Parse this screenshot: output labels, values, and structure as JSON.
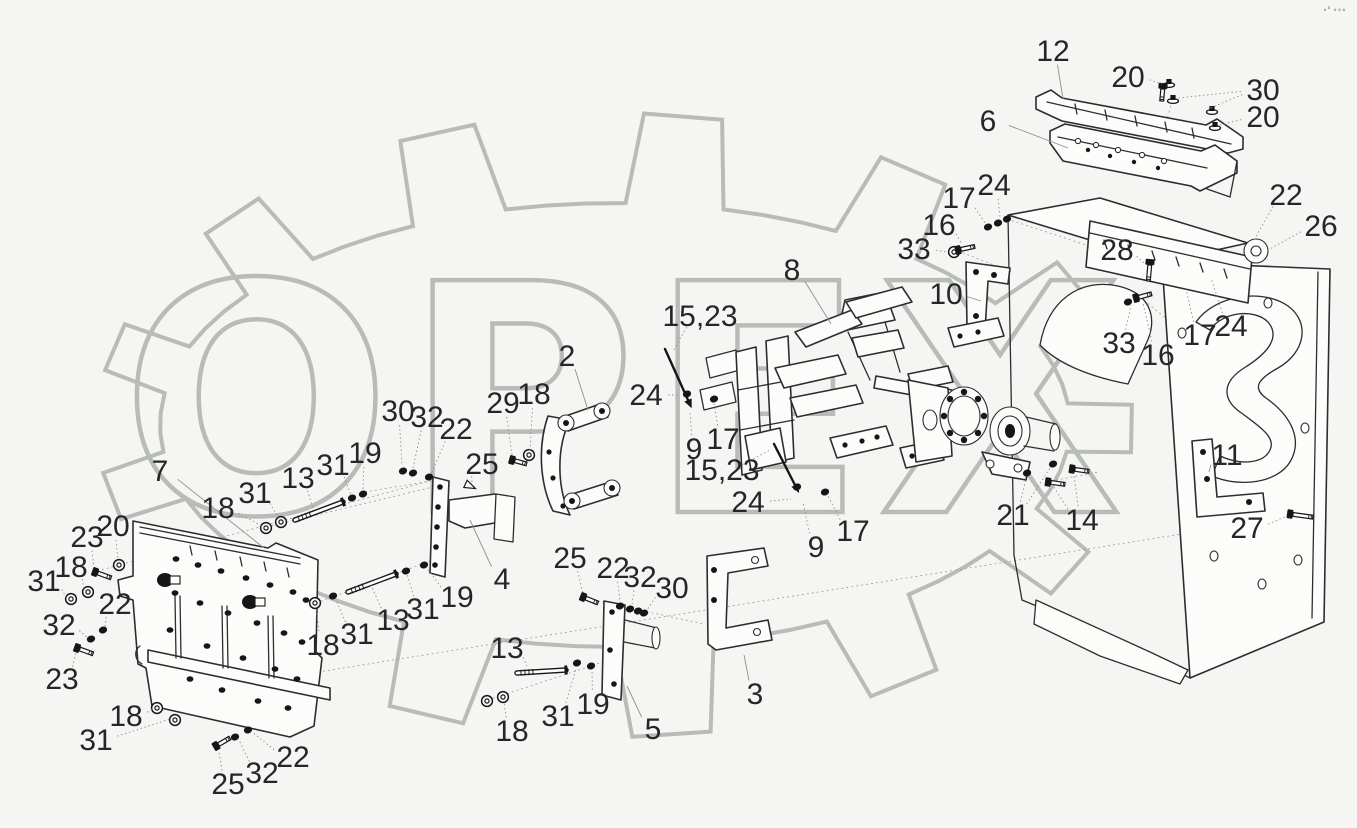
{
  "watermark": {
    "text": "ОРЕХ",
    "color": "#b8bcb8",
    "corner_mark": "∘° ∘∘∘"
  },
  "colors": {
    "background": "#f5f6f3",
    "line": "#2d2d2d",
    "label": "#262626",
    "leader": "#8f8f8f"
  },
  "labels": [
    {
      "t": "12",
      "x": 1053,
      "y": 51,
      "tx": 1063,
      "ty": 99,
      "solid": true
    },
    {
      "t": "20",
      "x": 1128,
      "y": 77,
      "tx": 1162,
      "ty": 84
    },
    {
      "t": "30",
      "x": 1263,
      "y": 90,
      "tx": 1208,
      "ty": 109,
      "tx2": 1178,
      "ty2": 98
    },
    {
      "t": "20",
      "x": 1263,
      "y": 117,
      "tx": 1220,
      "ty": 125
    },
    {
      "t": "6",
      "x": 988,
      "y": 121,
      "tx": 1068,
      "ty": 148,
      "solid": true
    },
    {
      "t": "24",
      "x": 994,
      "y": 185,
      "tx": 1000,
      "ty": 217
    },
    {
      "t": "17",
      "x": 959,
      "y": 198,
      "tx": 986,
      "ty": 224
    },
    {
      "t": "16",
      "x": 939,
      "y": 225,
      "tx": 961,
      "ty": 243
    },
    {
      "t": "33",
      "x": 914,
      "y": 249,
      "tx": 947,
      "ty": 252
    },
    {
      "t": "22",
      "x": 1286,
      "y": 195,
      "tx": 1254,
      "ty": 240
    },
    {
      "t": "26",
      "x": 1321,
      "y": 226,
      "tx": 1268,
      "ty": 250
    },
    {
      "t": "28",
      "x": 1117,
      "y": 250,
      "tx": 1145,
      "ty": 264
    },
    {
      "t": "8",
      "x": 792,
      "y": 270,
      "tx": 831,
      "ty": 324,
      "solid": true
    },
    {
      "t": "10",
      "x": 946,
      "y": 294,
      "tx": 981,
      "ty": 301,
      "solid": true
    },
    {
      "t": "33",
      "x": 1119,
      "y": 343,
      "tx": 1131,
      "ty": 305
    },
    {
      "t": "16",
      "x": 1158,
      "y": 355,
      "tx": 1143,
      "ty": 303
    },
    {
      "t": "17",
      "x": 1200,
      "y": 335,
      "tx": 1186,
      "ty": 289
    },
    {
      "t": "24",
      "x": 1231,
      "y": 326,
      "tx": 1211,
      "ty": 278
    },
    {
      "t": "15,23",
      "x": 700,
      "y": 316,
      "tx": 673,
      "ty": 351
    },
    {
      "t": "2",
      "x": 567,
      "y": 356,
      "tx": 588,
      "ty": 410,
      "solid": true
    },
    {
      "t": "24",
      "x": 646,
      "y": 395,
      "tx": 680,
      "ty": 395
    },
    {
      "t": "9",
      "x": 694,
      "y": 449,
      "tx": 690,
      "ty": 412
    },
    {
      "t": "17",
      "x": 723,
      "y": 439,
      "tx": 714,
      "ty": 403
    },
    {
      "t": "15,23",
      "x": 722,
      "y": 470,
      "tx": 770,
      "ty": 450
    },
    {
      "t": "24",
      "x": 748,
      "y": 502,
      "tx": 791,
      "ty": 499
    },
    {
      "t": "9",
      "x": 816,
      "y": 547,
      "tx": 803,
      "ty": 503
    },
    {
      "t": "17",
      "x": 853,
      "y": 531,
      "tx": 828,
      "ty": 496
    },
    {
      "t": "30",
      "x": 398,
      "y": 411,
      "tx": 402,
      "ty": 466
    },
    {
      "t": "32",
      "x": 427,
      "y": 417,
      "tx": 413,
      "ty": 468
    },
    {
      "t": "22",
      "x": 456,
      "y": 429,
      "tx": 431,
      "ty": 474
    },
    {
      "t": "29",
      "x": 503,
      "y": 403,
      "tx": 512,
      "ty": 455
    },
    {
      "t": "18",
      "x": 534,
      "y": 394,
      "tx": 530,
      "ty": 450
    },
    {
      "t": "25",
      "x": 482,
      "y": 464,
      "tx": 472,
      "ty": 483
    },
    {
      "t": "19",
      "x": 365,
      "y": 453,
      "tx": 363,
      "ty": 490
    },
    {
      "t": "31",
      "x": 333,
      "y": 465,
      "tx": 351,
      "ty": 495
    },
    {
      "t": "13",
      "x": 298,
      "y": 478,
      "tx": 313,
      "ty": 509
    },
    {
      "t": "31",
      "x": 255,
      "y": 493,
      "tx": 279,
      "ty": 519
    },
    {
      "t": "18",
      "x": 218,
      "y": 508,
      "tx": 262,
      "ty": 526
    },
    {
      "t": "7",
      "x": 160,
      "y": 471,
      "tx": 264,
      "ty": 548,
      "solid": true
    },
    {
      "t": "20",
      "x": 113,
      "y": 526,
      "tx": 118,
      "ty": 561
    },
    {
      "t": "23",
      "x": 87,
      "y": 537,
      "tx": 94,
      "ty": 567
    },
    {
      "t": "18",
      "x": 71,
      "y": 567,
      "tx": 84,
      "ty": 589
    },
    {
      "t": "31",
      "x": 44,
      "y": 581,
      "tx": 66,
      "ty": 597
    },
    {
      "t": "22",
      "x": 115,
      "y": 604,
      "tx": 105,
      "ty": 627
    },
    {
      "t": "32",
      "x": 59,
      "y": 625,
      "tx": 87,
      "ty": 637
    },
    {
      "t": "23",
      "x": 62,
      "y": 679,
      "tx": 76,
      "ty": 653
    },
    {
      "t": "18",
      "x": 126,
      "y": 716,
      "tx": 152,
      "ty": 709
    },
    {
      "t": "31",
      "x": 96,
      "y": 740,
      "tx": 170,
      "ty": 719
    },
    {
      "t": "25",
      "x": 228,
      "y": 784,
      "tx": 219,
      "ty": 752
    },
    {
      "t": "32",
      "x": 262,
      "y": 773,
      "tx": 239,
      "ty": 740
    },
    {
      "t": "22",
      "x": 293,
      "y": 757,
      "tx": 252,
      "ty": 732
    },
    {
      "t": "18",
      "x": 323,
      "y": 645,
      "tx": 316,
      "ty": 607
    },
    {
      "t": "31",
      "x": 357,
      "y": 634,
      "tx": 336,
      "ty": 600
    },
    {
      "t": "13",
      "x": 393,
      "y": 620,
      "tx": 371,
      "ty": 585
    },
    {
      "t": "31",
      "x": 423,
      "y": 609,
      "tx": 407,
      "ty": 574
    },
    {
      "t": "19",
      "x": 457,
      "y": 597,
      "tx": 427,
      "ty": 568
    },
    {
      "t": "4",
      "x": 502,
      "y": 579,
      "tx": 470,
      "ty": 520,
      "solid": true
    },
    {
      "t": "25",
      "x": 570,
      "y": 558,
      "tx": 583,
      "ty": 593
    },
    {
      "t": "22",
      "x": 613,
      "y": 568,
      "tx": 620,
      "ty": 601
    },
    {
      "t": "32",
      "x": 640,
      "y": 577,
      "tx": 632,
      "ty": 605
    },
    {
      "t": "30",
      "x": 672,
      "y": 588,
      "tx": 647,
      "ty": 610
    },
    {
      "t": "13",
      "x": 507,
      "y": 648,
      "tx": 527,
      "ty": 666
    },
    {
      "t": "31",
      "x": 558,
      "y": 716,
      "tx": 576,
      "ty": 669
    },
    {
      "t": "19",
      "x": 593,
      "y": 704,
      "tx": 592,
      "ty": 670
    },
    {
      "t": "18",
      "x": 512,
      "y": 731,
      "tx": 504,
      "ty": 702
    },
    {
      "t": "5",
      "x": 653,
      "y": 729,
      "tx": 627,
      "ty": 686,
      "solid": true
    },
    {
      "t": "3",
      "x": 755,
      "y": 694,
      "tx": 744,
      "ty": 655,
      "solid": true
    },
    {
      "t": "21",
      "x": 1013,
      "y": 515,
      "tx": 1026,
      "ty": 479,
      "tx2": 1050,
      "ty2": 468
    },
    {
      "t": "14",
      "x": 1082,
      "y": 520,
      "tx": 1074,
      "ty": 475,
      "tx2": 1052,
      "ty2": 484
    },
    {
      "t": "11",
      "x": 1227,
      "y": 455,
      "tx": 1209,
      "ty": 472,
      "solid": true
    },
    {
      "t": "27",
      "x": 1247,
      "y": 528,
      "tx": 1285,
      "ty": 517
    }
  ],
  "hardware": {
    "dots": [
      [
        403,
        471
      ],
      [
        413,
        473
      ],
      [
        429,
        477
      ],
      [
        988,
        227
      ],
      [
        998,
        223
      ],
      [
        1007,
        219
      ],
      [
        1128,
        302
      ],
      [
        687,
        394
      ],
      [
        714,
        399
      ],
      [
        797,
        487
      ],
      [
        825,
        492
      ],
      [
        620,
        606
      ],
      [
        630,
        609
      ],
      [
        638,
        611
      ],
      [
        644,
        613
      ],
      [
        103,
        630
      ],
      [
        91,
        639
      ],
      [
        235,
        737
      ],
      [
        248,
        730
      ],
      [
        333,
        596
      ],
      [
        406,
        571
      ],
      [
        424,
        565
      ],
      [
        577,
        663
      ],
      [
        591,
        666
      ],
      [
        352,
        498
      ],
      [
        363,
        494
      ],
      [
        1027,
        473
      ],
      [
        1053,
        464
      ]
    ],
    "rings": [
      [
        266,
        528
      ],
      [
        281,
        522
      ],
      [
        315,
        603
      ],
      [
        487,
        701
      ],
      [
        503,
        697
      ],
      [
        88,
        592
      ],
      [
        71,
        599
      ],
      [
        157,
        708
      ],
      [
        175,
        720
      ],
      [
        119,
        565
      ],
      [
        954,
        252
      ],
      [
        529,
        455
      ]
    ],
    "nuts": [
      [
        1169,
        83
      ],
      [
        1173,
        99
      ],
      [
        1212,
        110
      ],
      [
        1215,
        126
      ]
    ],
    "bolts": [
      [
        95,
        572,
        20,
        14
      ],
      [
        77,
        648,
        20,
        14
      ],
      [
        216,
        746,
        -30,
        13
      ],
      [
        583,
        597,
        22,
        13
      ],
      [
        512,
        460,
        15,
        12
      ],
      [
        958,
        250,
        -12,
        14
      ],
      [
        1136,
        298,
        -15,
        13
      ],
      [
        1163,
        86,
        95,
        12
      ],
      [
        1150,
        262,
        95,
        16
      ],
      [
        1048,
        482,
        8,
        14
      ],
      [
        1072,
        469,
        8,
        14
      ],
      [
        1290,
        514,
        8,
        20
      ]
    ],
    "studs": [
      [
        295,
        520,
        343,
        502
      ],
      [
        348,
        592,
        396,
        574
      ],
      [
        517,
        673,
        566,
        670
      ]
    ],
    "rods": [
      [
        665,
        349,
        688,
        400
      ],
      [
        774,
        444,
        795,
        485
      ]
    ],
    "cones": [
      [
        470,
        486,
        25
      ]
    ],
    "panel_dots": [
      [
        176,
        559
      ],
      [
        198,
        565
      ],
      [
        221,
        571
      ],
      [
        246,
        578
      ],
      [
        270,
        585
      ],
      [
        293,
        592
      ],
      [
        306,
        600
      ],
      [
        175,
        593
      ],
      [
        200,
        603
      ],
      [
        228,
        613
      ],
      [
        257,
        623
      ],
      [
        284,
        633
      ],
      [
        302,
        642
      ],
      [
        170,
        630
      ],
      [
        207,
        646
      ],
      [
        243,
        658
      ],
      [
        275,
        669
      ],
      [
        297,
        679
      ],
      [
        190,
        679
      ],
      [
        222,
        690
      ],
      [
        258,
        701
      ],
      [
        288,
        708
      ]
    ],
    "carriage_bolts": [
      [
        165,
        580
      ],
      [
        250,
        602
      ]
    ]
  }
}
